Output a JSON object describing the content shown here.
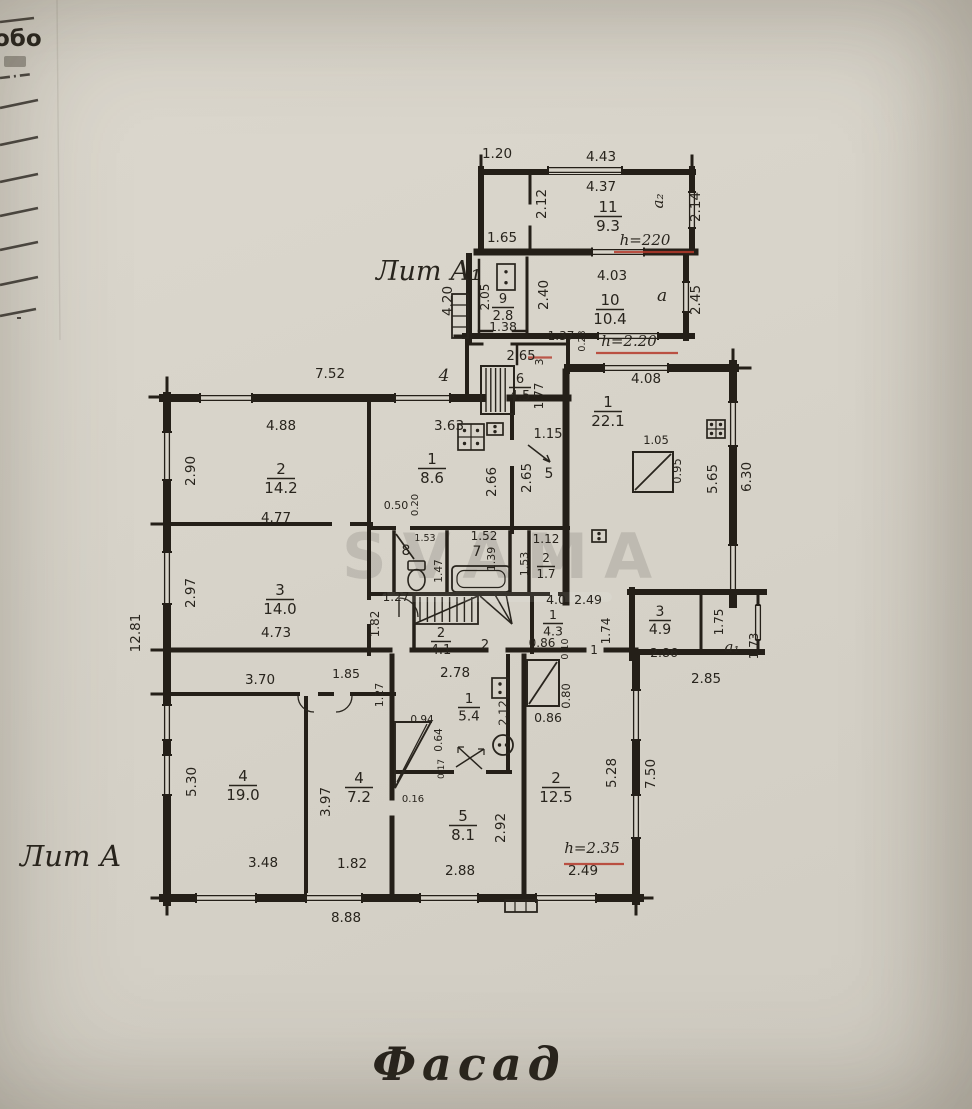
{
  "colors": {
    "paper": "#d7d3c9",
    "ink": "#28241d",
    "wall": "#241f18",
    "red": "#b5392b"
  },
  "titles": {
    "facade": "Фасад",
    "lit_a": "Лит А",
    "lit_a1": "Лит А₁",
    "edge_text": "обо",
    "watermark": "SVAMA"
  },
  "rooms": [
    {
      "n": "11",
      "a": "9.3",
      "x": 608,
      "y": 212
    },
    {
      "n": "9",
      "a": "2.8",
      "x": 503,
      "y": 303,
      "s": 13,
      "w": 22
    },
    {
      "n": "10",
      "a": "10.4",
      "x": 610,
      "y": 305
    },
    {
      "n": "6",
      "a": "4.5",
      "x": 520,
      "y": 383,
      "s": 13,
      "w": 22
    },
    {
      "n": "1",
      "a": "22.1",
      "x": 608,
      "y": 407
    },
    {
      "n": "2",
      "a": "14.2",
      "x": 281,
      "y": 474
    },
    {
      "n": "1",
      "a": "8.6",
      "x": 432,
      "y": 464
    },
    {
      "n": "2",
      "a": "1.7",
      "x": 546,
      "y": 562,
      "s": 12,
      "w": 18
    },
    {
      "n": "2",
      "a": "4.1",
      "x": 441,
      "y": 637,
      "s": 13,
      "w": 20
    },
    {
      "n": "1",
      "a": "4.3",
      "x": 553,
      "y": 619,
      "s": 12.5,
      "w": 20
    },
    {
      "n": "3",
      "a": "4.9",
      "x": 660,
      "y": 616,
      "s": 14,
      "w": 22
    },
    {
      "n": "3",
      "a": "14.0",
      "x": 280,
      "y": 595
    },
    {
      "n": "4",
      "a": "19.0",
      "x": 243,
      "y": 781
    },
    {
      "n": "4",
      "a": "7.2",
      "x": 359,
      "y": 783
    },
    {
      "n": "1",
      "a": "5.4",
      "x": 469,
      "y": 703,
      "s": 13.5,
      "w": 22
    },
    {
      "n": "5",
      "a": "8.1",
      "x": 463,
      "y": 821
    },
    {
      "n": "2",
      "a": "12.5",
      "x": 556,
      "y": 783
    }
  ],
  "dims": [
    {
      "t": "1.20",
      "x": 497,
      "y": 158
    },
    {
      "t": "4.43",
      "x": 601,
      "y": 161
    },
    {
      "t": "4.37",
      "x": 601,
      "y": 191
    },
    {
      "t": "2.12",
      "x": 546,
      "y": 204,
      "r": -90
    },
    {
      "t": "2.14",
      "x": 700,
      "y": 207,
      "r": -90
    },
    {
      "t": "1.65",
      "x": 502,
      "y": 242
    },
    {
      "t": "4.20",
      "x": 452,
      "y": 301,
      "r": -90
    },
    {
      "t": "2.05",
      "x": 489,
      "y": 297,
      "r": -90,
      "s": 12
    },
    {
      "t": "1.38",
      "x": 503,
      "y": 331,
      "s": 12.5
    },
    {
      "t": "2.40",
      "x": 548,
      "y": 295,
      "r": -90
    },
    {
      "t": "4.03",
      "x": 612,
      "y": 280
    },
    {
      "t": "2.45",
      "x": 700,
      "y": 300,
      "r": -90
    },
    {
      "t": "1.37",
      "x": 561,
      "y": 340,
      "s": 12
    },
    {
      "t": "0.28",
      "x": 585,
      "y": 341,
      "r": -90,
      "s": 9.5
    },
    {
      "t": "2.65",
      "x": 521,
      "y": 360,
      "s": 13
    },
    {
      "t": "3",
      "x": 543,
      "y": 362,
      "r": -90,
      "s": 11
    },
    {
      "t": "1.77",
      "x": 543,
      "y": 396,
      "r": -90,
      "s": 12
    },
    {
      "t": "7.52",
      "x": 330,
      "y": 378
    },
    {
      "t": "4.88",
      "x": 281,
      "y": 430
    },
    {
      "t": "2.90",
      "x": 195,
      "y": 471,
      "r": -90
    },
    {
      "t": "4.77",
      "x": 276,
      "y": 522
    },
    {
      "t": "3.63",
      "x": 449,
      "y": 430
    },
    {
      "t": "2.66",
      "x": 496,
      "y": 482,
      "r": -90
    },
    {
      "t": "2.65",
      "x": 531,
      "y": 478,
      "r": -90
    },
    {
      "t": "0.50",
      "x": 396,
      "y": 509,
      "s": 11
    },
    {
      "t": "0.20",
      "x": 418,
      "y": 505,
      "r": -90,
      "s": 10
    },
    {
      "t": "1.15",
      "x": 548,
      "y": 438,
      "s": 13
    },
    {
      "t": "4.08",
      "x": 646,
      "y": 383
    },
    {
      "t": "1.05",
      "x": 656,
      "y": 444,
      "s": 11.5
    },
    {
      "t": "0.95",
      "x": 681,
      "y": 471,
      "r": -90,
      "s": 11.5
    },
    {
      "t": "5.65",
      "x": 717,
      "y": 479,
      "r": -90
    },
    {
      "t": "6.30",
      "x": 751,
      "y": 477,
      "r": -90
    },
    {
      "t": "12.81",
      "x": 140,
      "y": 633,
      "r": -90
    },
    {
      "t": "2.97",
      "x": 195,
      "y": 593,
      "r": -90
    },
    {
      "t": "4.73",
      "x": 276,
      "y": 637
    },
    {
      "t": "1.52",
      "x": 484,
      "y": 540,
      "s": 12
    },
    {
      "t": "1.39",
      "x": 495,
      "y": 559,
      "r": -90,
      "s": 11
    },
    {
      "t": "1.12",
      "x": 546,
      "y": 543,
      "s": 12
    },
    {
      "t": "1.53",
      "x": 528,
      "y": 564,
      "r": -90,
      "s": 11
    },
    {
      "t": "1.53",
      "x": 425,
      "y": 541,
      "s": 9.5
    },
    {
      "t": "1.47",
      "x": 442,
      "y": 571,
      "r": -90,
      "s": 10.5
    },
    {
      "t": "1.27",
      "x": 396,
      "y": 601,
      "s": 12
    },
    {
      "t": "1.82",
      "x": 379,
      "y": 624,
      "r": -90,
      "s": 12
    },
    {
      "t": "2.78",
      "x": 455,
      "y": 677
    },
    {
      "t": "4.0",
      "x": 556,
      "y": 604,
      "s": 12.5
    },
    {
      "t": "2.49",
      "x": 588,
      "y": 604,
      "s": 12.5
    },
    {
      "t": "0.86",
      "x": 542,
      "y": 647,
      "s": 12
    },
    {
      "t": "0.10",
      "x": 568,
      "y": 649,
      "r": -90,
      "s": 9.5
    },
    {
      "t": "1.74",
      "x": 610,
      "y": 631,
      "r": -90,
      "s": 12
    },
    {
      "t": "2.86",
      "x": 664,
      "y": 657,
      "s": 12.5
    },
    {
      "t": "1.75",
      "x": 723,
      "y": 622,
      "r": -90,
      "s": 12
    },
    {
      "t": "2.85",
      "x": 706,
      "y": 683
    },
    {
      "t": "1.73",
      "x": 758,
      "y": 646,
      "r": -90,
      "s": 12
    },
    {
      "t": "3.70",
      "x": 260,
      "y": 684
    },
    {
      "t": "1.85",
      "x": 346,
      "y": 678,
      "s": 12.5
    },
    {
      "t": "1.27",
      "x": 383,
      "y": 695,
      "r": -90,
      "s": 11
    },
    {
      "t": "5.30",
      "x": 196,
      "y": 782,
      "r": -90
    },
    {
      "t": "3.48",
      "x": 263,
      "y": 867
    },
    {
      "t": "3.97",
      "x": 330,
      "y": 802,
      "r": -90
    },
    {
      "t": "1.82",
      "x": 352,
      "y": 868
    },
    {
      "t": "0.94",
      "x": 422,
      "y": 723,
      "s": 10.5
    },
    {
      "t": "0.64",
      "x": 442,
      "y": 740,
      "r": -90,
      "s": 10.5
    },
    {
      "t": "0.17",
      "x": 444,
      "y": 769,
      "r": -90,
      "s": 9
    },
    {
      "t": "0.16",
      "x": 413,
      "y": 802,
      "s": 10
    },
    {
      "t": "2.12",
      "x": 507,
      "y": 713,
      "r": -90,
      "s": 11.5
    },
    {
      "t": "2.92",
      "x": 505,
      "y": 828,
      "r": -90
    },
    {
      "t": "2.88",
      "x": 460,
      "y": 875
    },
    {
      "t": "0.80",
      "x": 570,
      "y": 696,
      "r": -90,
      "s": 11.5
    },
    {
      "t": "0.86",
      "x": 548,
      "y": 722,
      "s": 12.5
    },
    {
      "t": "5.28",
      "x": 616,
      "y": 773,
      "r": -90
    },
    {
      "t": "7.50",
      "x": 655,
      "y": 774,
      "r": -90
    },
    {
      "t": "2.49",
      "x": 583,
      "y": 875
    },
    {
      "t": "8.88",
      "x": 346,
      "y": 922
    }
  ],
  "labels": [
    {
      "t": "5",
      "x": 549,
      "y": 478,
      "s": 14
    },
    {
      "t": "8",
      "x": 406,
      "y": 555,
      "s": 14
    },
    {
      "t": "7",
      "x": 477,
      "y": 556,
      "s": 14
    },
    {
      "t": "2",
      "x": 485,
      "y": 649,
      "s": 13
    },
    {
      "t": "1",
      "x": 594,
      "y": 654,
      "s": 12
    },
    {
      "t": "4",
      "x": 444,
      "y": 381,
      "s": 17,
      "i": 1
    },
    {
      "t": "а₂",
      "x": 663,
      "y": 201,
      "r": -90,
      "s": 15,
      "i": 1
    },
    {
      "t": "а",
      "x": 662,
      "y": 301,
      "s": 17,
      "i": 1
    },
    {
      "t": "а₁",
      "x": 732,
      "y": 652,
      "s": 15,
      "i": 1
    }
  ],
  "heights": [
    {
      "t": "h=220",
      "x": 645,
      "y": 245,
      "ux1": 614,
      "ux2": 694,
      "uy": 252
    },
    {
      "t": "h=2.20",
      "x": 629,
      "y": 346,
      "ux1": 596,
      "ux2": 678,
      "uy": 353
    },
    {
      "t": "h=2.35",
      "x": 592,
      "y": 853,
      "ux1": 564,
      "ux2": 624,
      "uy": 864
    }
  ]
}
